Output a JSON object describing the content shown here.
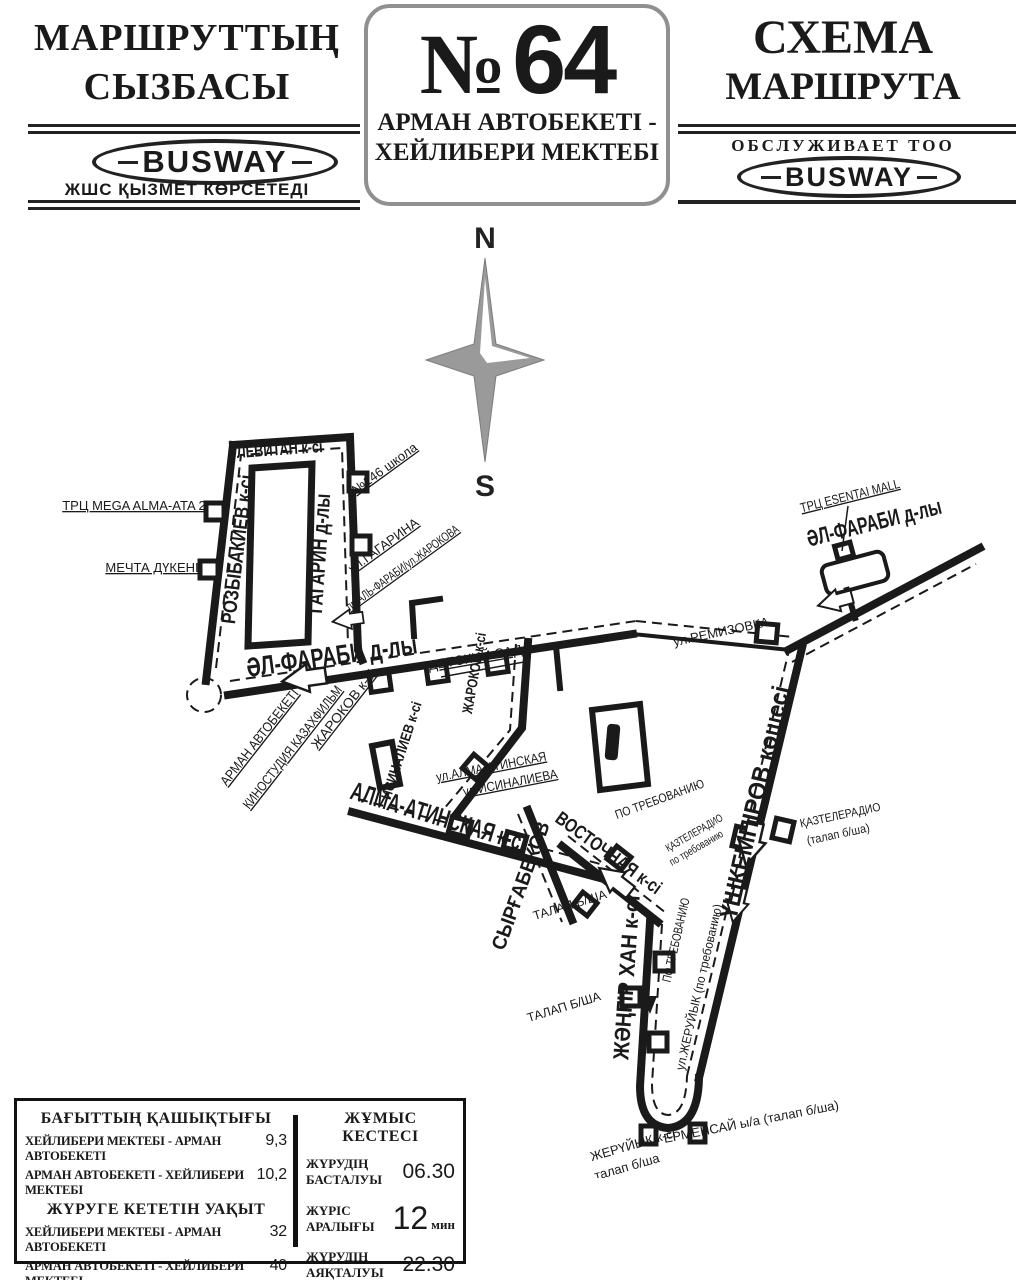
{
  "header": {
    "left": {
      "title_line1": "МАРШРУТТЫҢ",
      "title_line2": "СЫЗБАСЫ",
      "busway": "BUSWAY",
      "subtitle": "ЖШС ҚЫЗМЕТ КӨРСЕТЕДІ"
    },
    "center": {
      "no_sign": "№",
      "route_number": "64",
      "dest_line1": "АРМАН АВТОБЕКЕТІ -",
      "dest_line2": "ХЕЙЛИБЕРИ МЕКТЕБІ"
    },
    "right": {
      "title_line1": "СХЕМА",
      "title_line2": "МАРШРУТА",
      "served_by": "ОБСЛУЖИВАЕТ ТОО",
      "busway": "BUSWAY"
    }
  },
  "map": {
    "compass": {
      "north": "N",
      "south": "S"
    },
    "streets": {
      "levitan": "ЛЕВИТАН к-сі",
      "rozybakiev": "РОЗЫБАКИЕВ к-сі",
      "gagarin": "ГАГАРИН д-лы",
      "alfarabi_left": "ӘЛ-ФАРАБИ д-лы",
      "zharokov": "ЖАРОКОВ к-сі",
      "isinaliev": "ИСИНАЛИЕВ к-сі",
      "alma_atinskaya": "АЛМА-АТИНСКАЯ к-сі",
      "syrgabekov": "СЫРҒАБЕКОВ",
      "vostochnaya": "ВОСТОЧНАЯ к-сі",
      "zhangir_khan": "ЖӘҢГІР ХАН к-сі",
      "ushkempirov": "ҮШКЕМПІРОВ көшесі",
      "alfarabi_right": "ӘЛ-ФАРАБИ д-лы"
    },
    "stops": {
      "mega": "ТРЦ MEGA ALMA-ATA 2",
      "mechta": "МЕЧТА ДҮКЕНІ",
      "school146": "№146 школа",
      "gagarina": "ул.ГАГАРИНА",
      "alfarabi_zharokova": "пр.АЛЬ-ФАРАБИ/ул.ЖАРОКОВА",
      "detskiy_sad": "ДЕТСКИЙ САД",
      "arman": "АРМАН АВТОБЕКЕТІ",
      "kinostudiya": "КИНОСТУДИЯ КАЗАХФИЛЬМ",
      "zharokov_stop": "ЖАРОКОВ к-сі",
      "ul_alma_atinskaya": "ул.АЛМА-АТИНСКАЯ",
      "ul_isinalieva": "ул.ИСИНАЛИЕВА",
      "po_trebovaniyu_vostochnaya": "ПО ТРЕБОВАНИЮ",
      "kaztele_left_line1": "ҚАЗТЕЛЕРАДИО",
      "kaztele_left_line2": "по требованию",
      "kaztele_right_line1": "ҚАЗТЕЛЕРАДИО",
      "kaztele_right_line2": "(талап б/ша)",
      "talap_1": "ТАЛАП Б/ША",
      "talap_2": "ТАЛАП Б/ША",
      "po_trebovaniyu_zhangir": "ПО ТРЕБОВАНИЮ",
      "zheruyik_po_treb": "ул.ЖЕРУЙЫК (по требованию)",
      "zheruyik_line1": "ЖЕРҮЙЫҚ к-сі",
      "zheruyik_line2": "талап б/ша",
      "ermensay": "ЕРМЕНСАЙ ы/а (талап б/ша)",
      "remizovka": "ул.РЕМИЗОВКА",
      "esentai": "ТРЦ ESENTAI MALL"
    }
  },
  "info": {
    "distance": {
      "title": "БАҒЫТТЫҢ ҚАШЫҚТЫҒЫ",
      "rows": [
        {
          "label": "ХЕЙЛИБЕРИ МЕКТЕБІ - АРМАН АВТОБЕКЕТІ",
          "value": "9,3"
        },
        {
          "label": "АРМАН АВТОБЕКЕТІ - ХЕЙЛИБЕРИ МЕКТЕБІ",
          "value": "10,2"
        }
      ]
    },
    "time": {
      "title": "ЖҮРУГЕ КЕТЕТІН УАҚЫТ",
      "rows": [
        {
          "label": "ХЕЙЛИБЕРИ МЕКТЕБІ - АРМАН АВТОБЕКЕТІ",
          "value": "32"
        },
        {
          "label": "АРМАН АВТОБЕКЕТІ - ХЕЙЛИБЕРИ МЕКТЕБІ",
          "value": "40"
        }
      ]
    },
    "schedule": {
      "title": "ЖҰМЫС КЕСТЕСІ",
      "start_label": "ЖҮРУДІҢ БАСТАЛУЫ",
      "start_value": "06.30",
      "interval_label": "ЖҮРІС АРАЛЫҒЫ",
      "interval_value": "12",
      "interval_unit": "мин",
      "end_label": "ЖҮРУДІҢ АЯҚТАЛУЫ",
      "end_value": "22.30"
    }
  }
}
